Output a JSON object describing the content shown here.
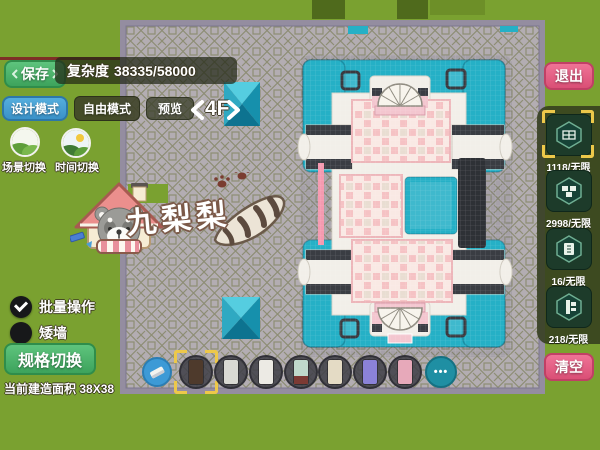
{
  "topbar": {
    "save": "保存",
    "complexity_label": "复杂度",
    "complexity_value": "38335/58000",
    "design_mode": "设计模式",
    "free_mode": "自由模式",
    "preview": "预览",
    "floor": "4F"
  },
  "left": {
    "scene_switch": "场景切换",
    "time_switch": "时间切换",
    "batch_op": "批量操作",
    "low_wall": "矮墙",
    "spec_switch": "规格切换",
    "build_area_label": "当前建造面积",
    "build_area_value": "38X38"
  },
  "logo": {
    "player_name": "九梨梨"
  },
  "right": {
    "exit": "退出",
    "clear": "清空",
    "resources": [
      {
        "name": "wall-block",
        "count": "1118/无限",
        "selected": true
      },
      {
        "name": "brick-block",
        "count": "2998/无限",
        "selected": false
      },
      {
        "name": "tile-block",
        "count": "16/无限",
        "selected": false
      },
      {
        "name": "pillar-block",
        "count": "218/无限",
        "selected": false
      }
    ]
  },
  "toolbar": {
    "more_label": "•••",
    "items": [
      {
        "name": "dark-wood-wall",
        "color": "#4e3a2c",
        "selected": true
      },
      {
        "name": "white-column",
        "color": "#d9d9d3",
        "selected": false
      },
      {
        "name": "white-panel",
        "color": "#eceae4",
        "selected": false
      },
      {
        "name": "teal-panel",
        "color": "#bfd8cb",
        "accent": "#7c3a34",
        "selected": false
      },
      {
        "name": "beige-cabinet",
        "color": "#e4dbc5",
        "selected": false
      },
      {
        "name": "purple-cabinet",
        "color": "#8b82d8",
        "selected": false
      },
      {
        "name": "pink-cabinet",
        "color": "#e7a9ba",
        "selected": false
      }
    ]
  },
  "colors": {
    "teal_roof": "#25b0c6",
    "pink_floor": "#f5c2c4",
    "grass": "#7aa130",
    "button_green": "#4db36a",
    "button_pink": "#e05a7f"
  }
}
